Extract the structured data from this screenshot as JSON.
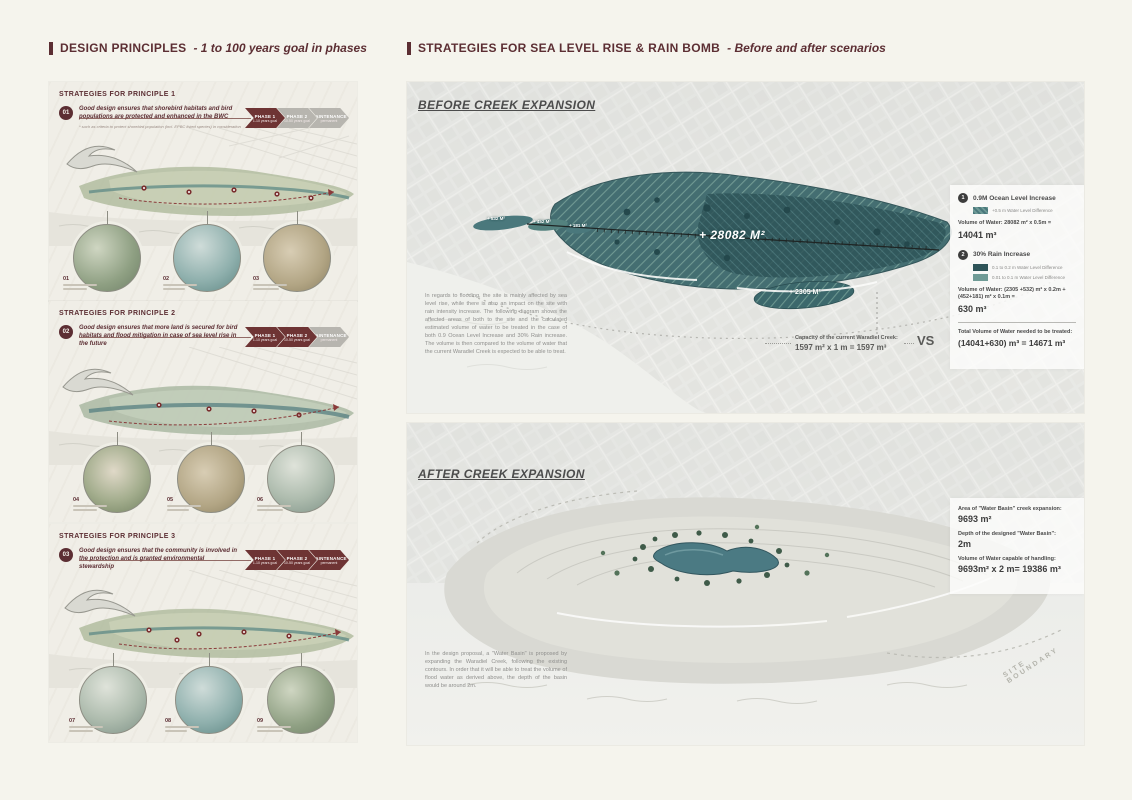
{
  "colors": {
    "accent": "#6e3434",
    "accent_dark": "#5c2e33",
    "teal_dark": "#2e5458",
    "teal": "#3c686c",
    "teal_light": "#6f9b96"
  },
  "headers": {
    "left": {
      "title": "DESIGN PRINCIPLES",
      "subtitle": "- 1 to 100 years goal in phases"
    },
    "right": {
      "title": "STRATEGIES FOR SEA LEVEL RISE & RAIN BOMB",
      "subtitle": "- Before and after scenarios"
    }
  },
  "principles": [
    {
      "header": "STRATEGIES FOR PRINCIPLE 1",
      "badge": "01",
      "statement": "Good design ensures that shorebird habitats and bird populations are protected and enhanced in the BWC",
      "footnote": "* such as criteria to protect shorebird population (incl. EPBC listed species) in consideration",
      "phases": [
        {
          "label": "PHASE 1",
          "sub": "1-10 years goal"
        },
        {
          "label": "PHASE 2",
          "sub": "10-50 years goal"
        },
        {
          "label": "MAINTENANCE",
          "sub": "permanent"
        }
      ],
      "insets": [
        {
          "num": "01"
        },
        {
          "num": "02"
        },
        {
          "num": "03"
        }
      ]
    },
    {
      "header": "STRATEGIES FOR PRINCIPLE 2",
      "badge": "02",
      "statement": "Good design ensures that more land is secured for bird habitats and flood mitigation in case of sea level rise in the future",
      "phases": [
        {
          "label": "PHASE 1",
          "sub": "1-10 years goal"
        },
        {
          "label": "PHASE 2",
          "sub": "10-50 years goal"
        },
        {
          "label": "MAINTENANCE",
          "sub": "permanent"
        }
      ],
      "insets": [
        {
          "num": "04"
        },
        {
          "num": "05"
        },
        {
          "num": "06"
        }
      ]
    },
    {
      "header": "STRATEGIES FOR PRINCIPLE 3",
      "badge": "03",
      "statement": "Good design ensures that the community is involved in the protection and is granted environmental stewardship",
      "phases": [
        {
          "label": "PHASE 1",
          "sub": "1-10 years goal"
        },
        {
          "label": "PHASE 2",
          "sub": "10-50 years goal"
        },
        {
          "label": "MAINTENANCE",
          "sub": "permanent"
        }
      ],
      "insets": [
        {
          "num": "07"
        },
        {
          "num": "08"
        },
        {
          "num": "09"
        }
      ]
    }
  ],
  "before": {
    "heading": "BEFORE CREEK EXPANSION",
    "paragraph": "In regards to flooding, the site is mainly affected by sea level rise, while there is also an impact on the site with rain intensity increase. The following diagram shows the affected areas of both to the site and the calculated estimated volume of water to be treated in the case of both 0.9 Ocean Level Increase and 30% Rain increase. The volume is then compared to the volume of water that the current Waradiel Creek is expected to be able to treat.",
    "map_labels": {
      "main": "+ 28082 M²",
      "secondary": "+ 2305 M²",
      "small_1": "+ 532 M²",
      "small_2": "+ 452 M²",
      "small_3": "+ 181 M²"
    },
    "capacity": {
      "label": "Capacity of the current Waradiel Creek:",
      "value": "1597 m² x 1 m  = 1597 m³"
    },
    "vs": "VS",
    "legend": {
      "items": [
        {
          "num": "1",
          "title": "0.9M Ocean Level Increase",
          "swatches": [
            {
              "label": "+0.5 m Water Level Difference"
            }
          ],
          "formula": "Volume of Water: 28082 m² x 0.5m =",
          "result": "14041 m³"
        },
        {
          "num": "2",
          "title": "30% Rain Increase",
          "swatches": [
            {
              "label": "0.1 to 0.2 m Water Level Difference"
            },
            {
              "label": "0.01 to 0.1 m Water Level Difference"
            }
          ],
          "formula": "Volume of Water: (2305 +532) m² x 0.2m + (452+181) m² x 0.1m  =",
          "result": "630 m³"
        }
      ],
      "total_label": "Total Volume of Water needed to be treated:",
      "total_value": "(14041+630) m³ = 14671 m³"
    }
  },
  "after": {
    "heading": "AFTER CREEK EXPANSION",
    "paragraph": "In the design proposal, a \"Water Basin\" is proposed by expanding the Waradiel Creek, following the existing contours. In order that it will be able to treat the volume of flood water as derived above, the depth of the basin would be around 2m.",
    "stats": [
      {
        "label": "Area of \"Water Basin\" creek expansion:",
        "value": "9693 m²"
      },
      {
        "label": "Depth of  the designed \"Water Basin\":",
        "value": "2m"
      },
      {
        "label": "Volume of Water capable of handling:",
        "value": "9693m² x 2 m= 19386 m³"
      }
    ],
    "site_boundary": "SITE BOUNDARY"
  }
}
